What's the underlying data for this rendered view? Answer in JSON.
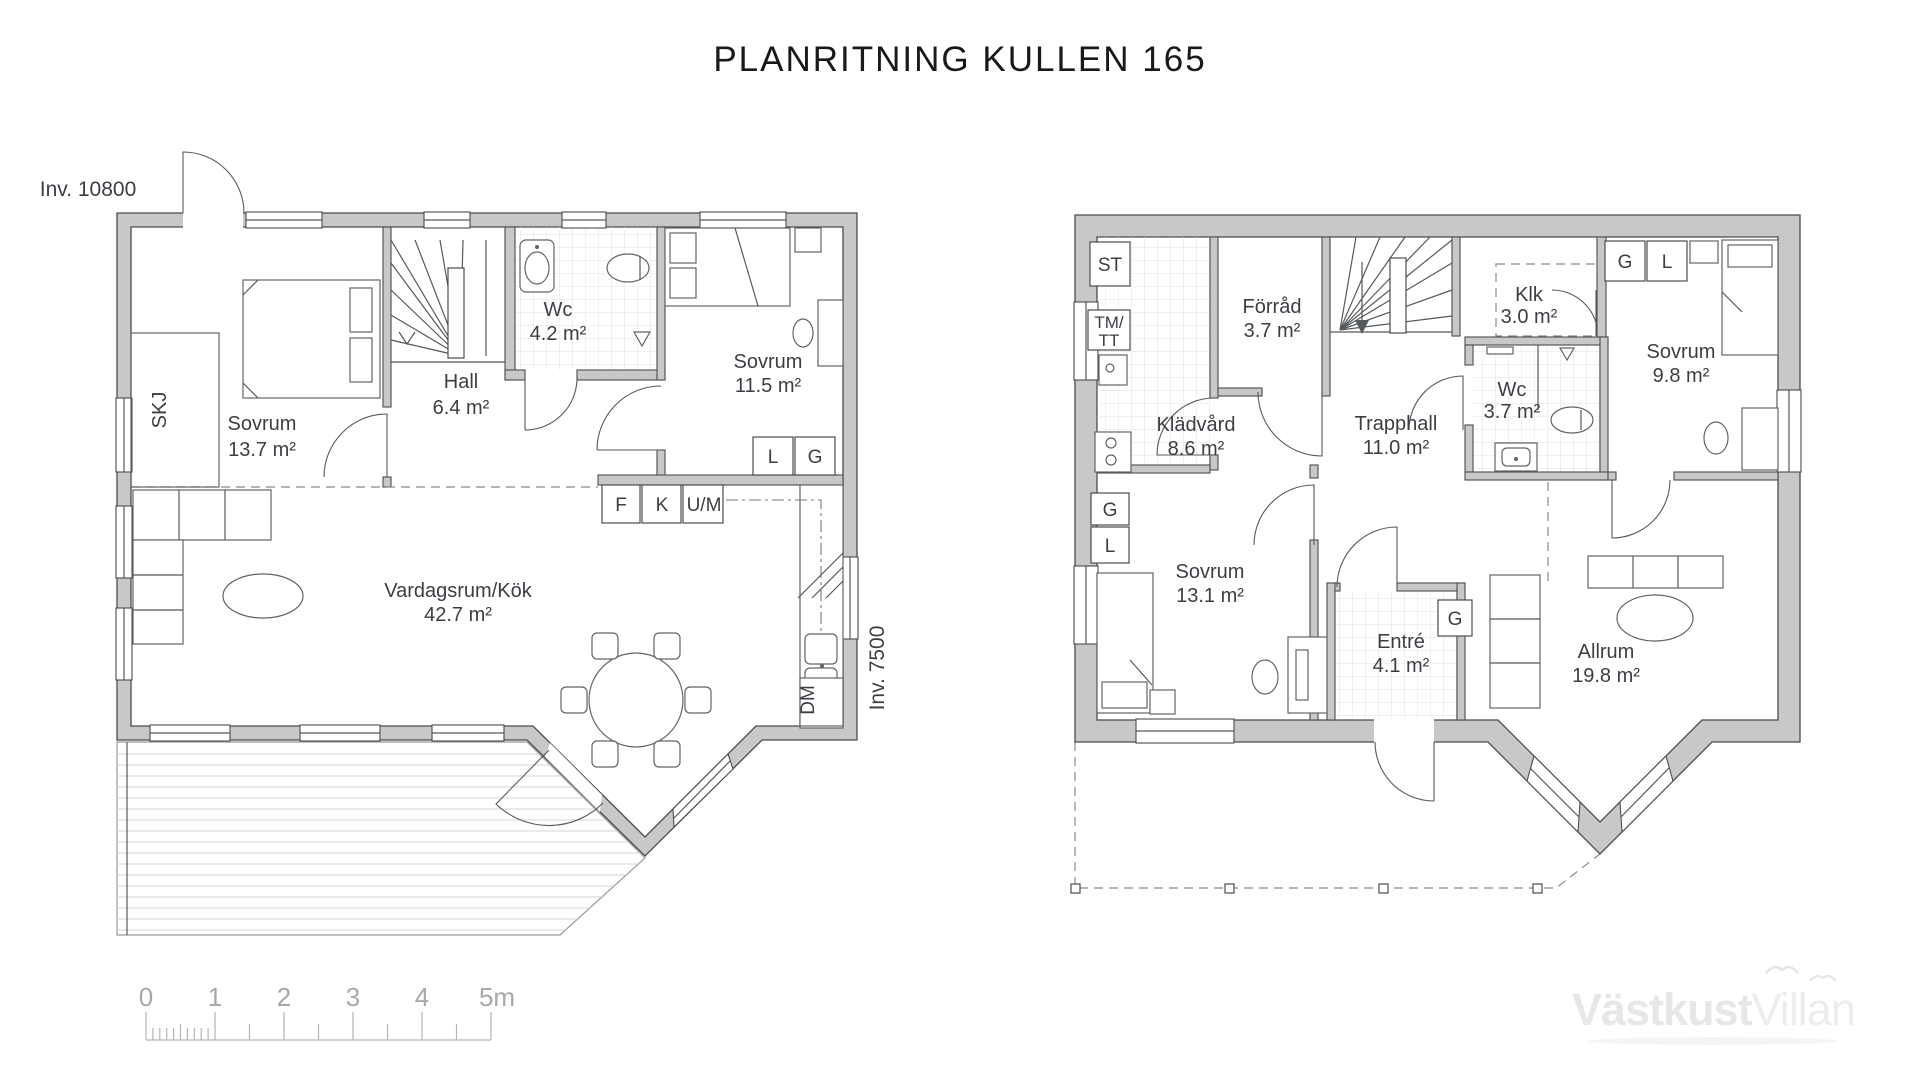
{
  "title": "PLANRITNING KULLEN 165",
  "floor1": {
    "dim_top": "Inv. 10800",
    "dim_right": "Inv. 7500",
    "skj": "SKJ",
    "dm": "DM",
    "wardrobe_l": "L",
    "wardrobe_g": "G",
    "appl_f": "F",
    "appl_k": "K",
    "appl_um": "U/M",
    "rooms": {
      "sovrum1": {
        "name": "Sovrum",
        "area": "13.7 m²"
      },
      "hall": {
        "name": "Hall",
        "area": "6.4 m²"
      },
      "wc": {
        "name": "Wc",
        "area": "4.2 m²"
      },
      "sovrum2": {
        "name": "Sovrum",
        "area": "11.5 m²"
      },
      "vardagsrum": {
        "name": "Vardagsrum/Kök",
        "area": "42.7 m²"
      }
    }
  },
  "floor2": {
    "st": "ST",
    "tm": "TM/",
    "tt": "TT",
    "g_top": "G",
    "l_top": "L",
    "g_left": "G",
    "l_left": "L",
    "g_entre": "G",
    "rooms": {
      "forrad": {
        "name": "Förråd",
        "area": "3.7 m²"
      },
      "klk": {
        "name": "Klk",
        "area": "3.0 m²"
      },
      "sovrum3": {
        "name": "Sovrum",
        "area": "9.8 m²"
      },
      "kladvard": {
        "name": "Klädvård",
        "area": "8.6 m²"
      },
      "trapphall": {
        "name": "Trapphall",
        "area": "11.0 m²"
      },
      "wc2": {
        "name": "Wc",
        "area": "3.7 m²"
      },
      "sovrum4": {
        "name": "Sovrum",
        "area": "13.1 m²"
      },
      "entre": {
        "name": "Entré",
        "area": "4.1 m²"
      },
      "allrum": {
        "name": "Allrum",
        "area": "19.8 m²"
      }
    }
  },
  "scalebar": {
    "labels": [
      "0",
      "1",
      "2",
      "3",
      "4",
      "5m"
    ]
  },
  "logo": {
    "bold": "Västkust",
    "light": "Villan"
  }
}
